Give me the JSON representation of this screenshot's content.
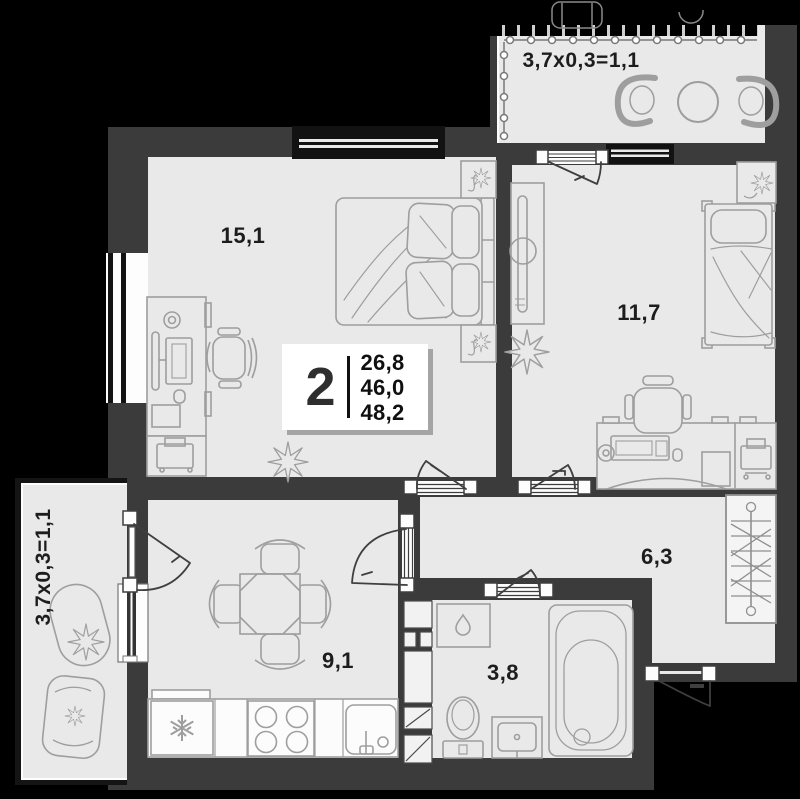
{
  "badge": {
    "rooms_count": "2",
    "areas": [
      "26,8",
      "46,0",
      "48,2"
    ]
  },
  "rooms": {
    "bedroom": {
      "label": "15,1"
    },
    "bedroom2": {
      "label": "11,7"
    },
    "hallway": {
      "label": "6,3"
    },
    "kitchen": {
      "label": "9,1"
    },
    "bathroom": {
      "label": "3,8"
    }
  },
  "balconies": {
    "top": {
      "label": "3,7x0,3=1,1"
    },
    "left": {
      "label": "3,7x0,3=1,1"
    }
  },
  "colors": {
    "background": "#000000",
    "wall": "#3b3b3b",
    "floor": "#e9e9e9",
    "furniture_stroke": "#9e9e9e",
    "door_stroke": "#3f3f3f",
    "label_text": "#1d1d1d",
    "badge_bg": "#ffffff"
  },
  "icons": {
    "fridge": "snowflake-icon",
    "washing_machine": "water-drop-icon"
  }
}
